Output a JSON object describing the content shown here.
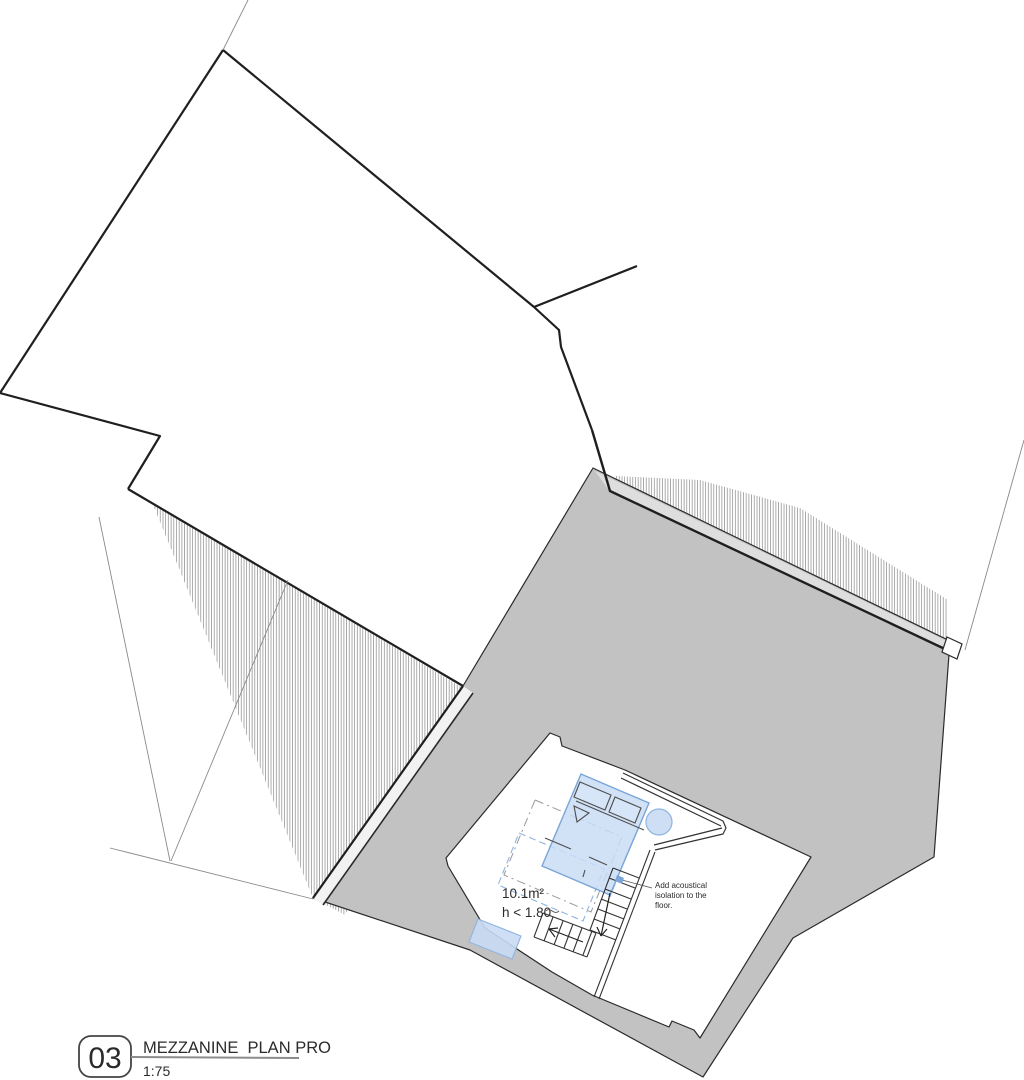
{
  "plan": {
    "room": {
      "area_label": "10.1m²",
      "height_label": "h < 1.80"
    },
    "annotation": {
      "line1": "Add acoustical",
      "line2": "isolation to the",
      "line3": "floor."
    }
  },
  "title_block": {
    "number": "03",
    "title": "MEZZANINE  PLAN PRO",
    "scale": "1:75"
  },
  "colors": {
    "roof_gray": "#c2c2c2",
    "eave_band_light": "#dedede",
    "furniture_blue_fill": "#c9dcf4",
    "furniture_blue_stroke": "#7aa5d6",
    "furniture_blue_light_stroke": "#8fb4e0",
    "outline_dark": "#1f1f1f",
    "thin_line_gray": "#8a8a8a"
  }
}
